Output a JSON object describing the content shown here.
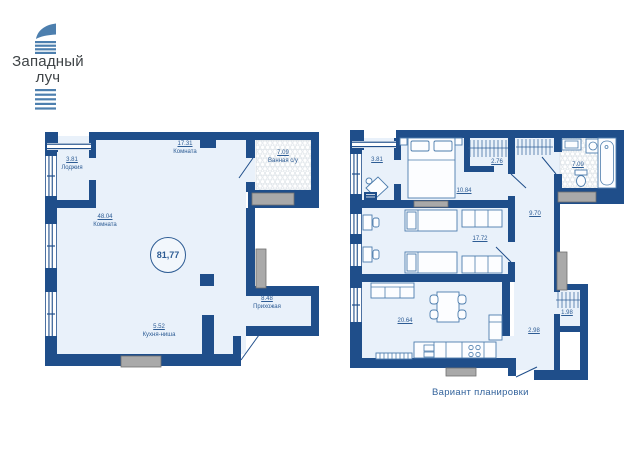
{
  "logo": {
    "line1": "Западный",
    "line2": "луч"
  },
  "caption": "Вариант планировки",
  "colors": {
    "wall_navy": "#1f4e8a",
    "floor_light": "#e9f1fa",
    "label_blue": "#2d5c94",
    "caption_blue": "#33639c",
    "logo_blue": "#4d7fae",
    "logo_text_gray": "#3f4447",
    "gray_fixture": "#a9a9a9",
    "tile_outline": "#dde3e8"
  },
  "icons": [
    "double-bed-icon",
    "single-bed-icon",
    "desk-icon",
    "chair-icon",
    "wardrobe-hanger-icon",
    "sofa-icon",
    "dining-table-icon",
    "kitchen-counter-icon",
    "sink-icon",
    "stove-burners-icon",
    "fridge-icon",
    "washing-machine-icon",
    "bathtub-icon",
    "toilet-icon",
    "door-swing-icon",
    "window-icon",
    "ac-basket-icon"
  ],
  "plans": {
    "left": {
      "title": "floorplan-original",
      "total_area": "81,77",
      "rooms": [
        {
          "area": "17.31",
          "name": "Комната"
        },
        {
          "area": "3.81",
          "name": "Лоджия"
        },
        {
          "area": "48.04",
          "name": "Комната"
        },
        {
          "area": "7.09",
          "name": "Ванная с/у"
        },
        {
          "area": "8.48",
          "name": "Прихожая"
        },
        {
          "area": "5.52",
          "name": "Кухня-ниша"
        }
      ]
    },
    "right": {
      "title": "floorplan-variant",
      "rooms": [
        {
          "area": "3.81"
        },
        {
          "area": "10.84"
        },
        {
          "area": "2.76"
        },
        {
          "area": "7.09"
        },
        {
          "area": "9.70"
        },
        {
          "area": "17.72"
        },
        {
          "area": "20.64"
        },
        {
          "area": "1.98"
        },
        {
          "area": "2.98"
        }
      ]
    }
  }
}
